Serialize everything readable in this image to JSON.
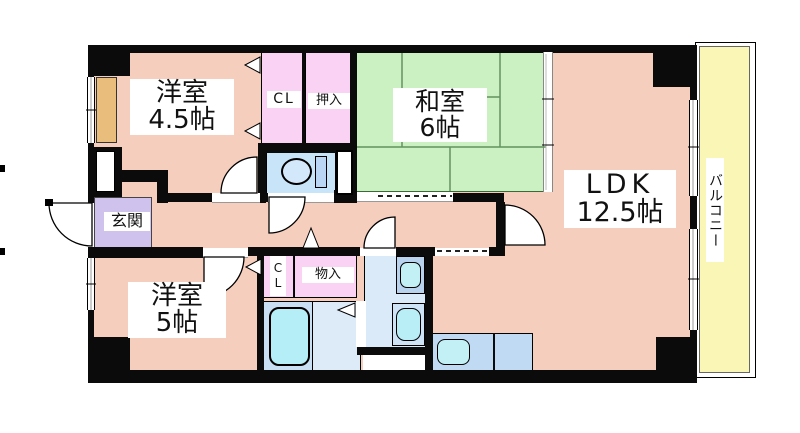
{
  "plan_title": "apartment-floor-plan",
  "rooms": {
    "western1": {
      "name": "洋室",
      "size": "4.5帖"
    },
    "japanese": {
      "name": "和室",
      "size": "6帖"
    },
    "ldk": {
      "name": "LDK",
      "size": "12.5帖"
    },
    "western2": {
      "name": "洋室",
      "size": "5帖"
    },
    "entrance": {
      "name": "玄関"
    },
    "balcony": {
      "name": "バルコニー"
    },
    "closet_upper": {
      "name": "CL"
    },
    "oshiire": {
      "name": "押入"
    },
    "closet_lower": {
      "name": "CL"
    },
    "storage": {
      "name": "物入"
    }
  },
  "colors": {
    "room_pink": "#F6CEBD",
    "tatami_green": "#CBF0C1",
    "closet_pink": "#FAD3F4",
    "balcony_yellow": "#FAF6B5",
    "entrance_purple": "#CFC3EE",
    "water_blue": "#DBEAF8",
    "toilet_blue": "#C7E4F8",
    "fixture_cyan": "#B5EEF6",
    "counter_blue": "#C1DAF3",
    "tan_shaft": "#E9BE7D",
    "wall_black": "#0B0B0B"
  }
}
